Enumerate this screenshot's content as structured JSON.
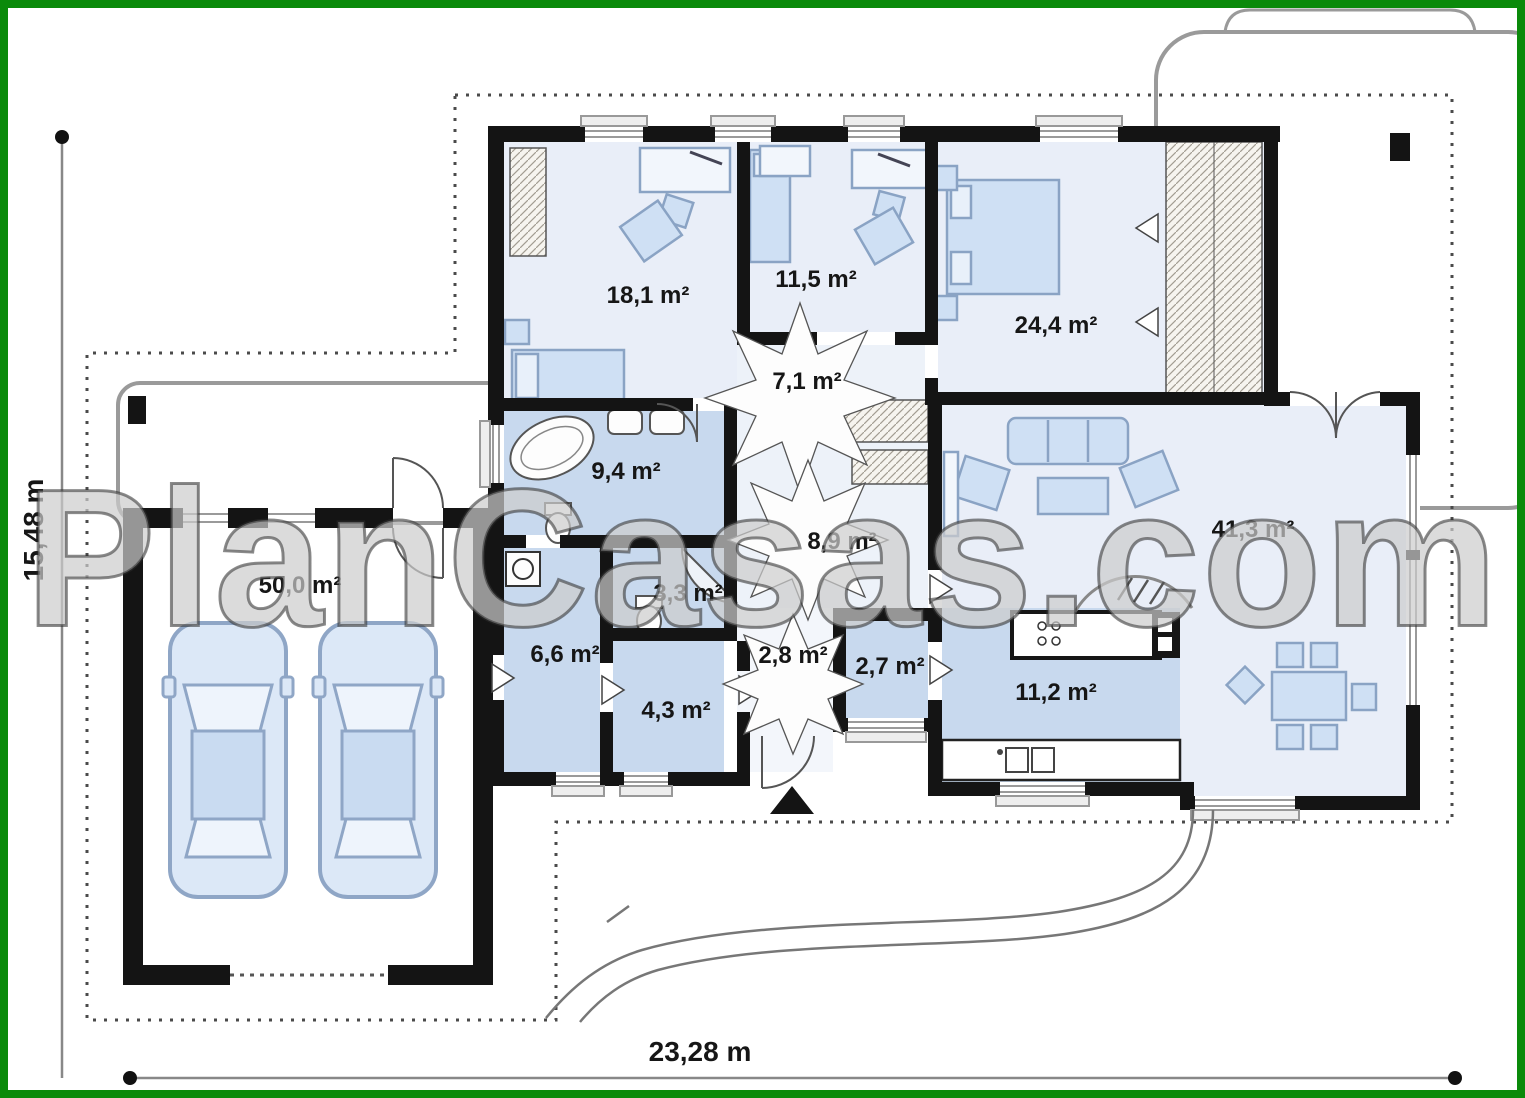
{
  "watermark": {
    "text": "PlanCasas.com"
  },
  "dimensions": {
    "width": "23,28 m",
    "height": "15,48 m"
  },
  "rooms": [
    {
      "id": "bedroom-1",
      "area": "18,1 m²"
    },
    {
      "id": "bedroom-2",
      "area": "11,5 m²"
    },
    {
      "id": "bedroom-3",
      "area": "24,4 m²"
    },
    {
      "id": "hall",
      "area": "7,1 m²"
    },
    {
      "id": "bathroom",
      "area": "9,4 m²"
    },
    {
      "id": "corridor",
      "area": "8,9 m²"
    },
    {
      "id": "living-room",
      "area": "41,3 m²"
    },
    {
      "id": "garage",
      "area": "50,0 m²"
    },
    {
      "id": "wc",
      "area": "3,3 m²"
    },
    {
      "id": "utility",
      "area": "6,6 m²"
    },
    {
      "id": "entry",
      "area": "2,8 m²"
    },
    {
      "id": "pantry",
      "area": "2,7 m²"
    },
    {
      "id": "storage",
      "area": "4,3 m²"
    },
    {
      "id": "kitchen",
      "area": "11,2 m²"
    }
  ],
  "colors": {
    "frame_border": "#0a8a0a",
    "wall": "#141414",
    "room_light": "#e9eef8",
    "room_blue": "#c8d9ee",
    "furniture_fill": "#cfe0f4",
    "furniture_stroke": "#8aa3c4"
  }
}
